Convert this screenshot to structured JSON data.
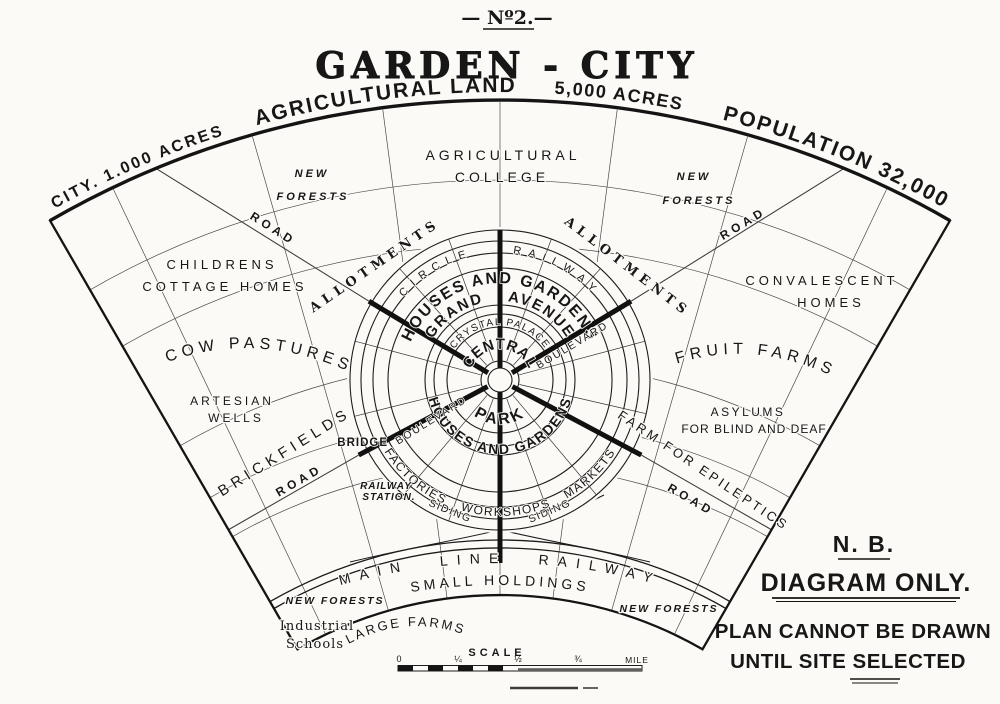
{
  "page": {
    "paper_color": "#fbfaf6",
    "ink_color": "#171717"
  },
  "header": {
    "number_label": "— Nº2.—",
    "title": "GARDEN - CITY"
  },
  "arc_titles": {
    "city_acres": "CITY. 1.000 ACRES",
    "agricultural_land": "AGRICULTURAL LAND",
    "acres_5000": "5,000 ACRES",
    "population": "POPULATION 32,000"
  },
  "city": {
    "circle_railway": "CIRCLE RAILWAY",
    "houses_gardens_top": "HOUSES AND GARDENS",
    "grand_avenue": "GRAND AVENUE",
    "crystal_palace": "CRYSTAL PALACE",
    "central": "CENTRAL",
    "park": "PARK",
    "houses_gardens_bottom": "HOUSES AND GARDENS",
    "factories": "FACTORIES WORKSHOPS MARKETS",
    "boulevard_upper": "BOULEVARD",
    "boulevard_lower": "BOULEVARD",
    "siding_left": "SIDING",
    "siding_right": "SIDING",
    "bridge": "BRIDGE",
    "railway_station_1": "RAILWAY",
    "railway_station_2": "STATION."
  },
  "belt": {
    "agricultural_college_1": "AGRICULTURAL",
    "agricultural_college_2": "COLLEGE",
    "new_forests_top_left_1": "NEW",
    "new_forests_top_left_2": "FORESTS",
    "new_forests_top_right_1": "NEW",
    "new_forests_top_right_2": "FORESTS",
    "childrens_1": "CHILDRENS",
    "childrens_2": "COTTAGE HOMES",
    "convalescent_1": "CONVALESCENT",
    "convalescent_2": "HOMES",
    "cow_pastures": "COW PASTURES",
    "fruit_farms": "FRUIT FARMS",
    "artesian_1": "ARTESIAN",
    "artesian_2": "WELLS",
    "brickfields": "BRICKFIELDS",
    "allotments_left": "ALLOTMENTS",
    "allotments_right": "ALLOTMENTS",
    "asylums_1": "ASYLUMS",
    "asylums_2": "FOR BLIND AND DEAF",
    "farm_epileptics": "FARM FOR EPILEPTICS",
    "road_upper_left": "ROAD",
    "road_upper_right": "ROAD",
    "road_lower_left": "ROAD",
    "road_lower_right": "ROAD",
    "main_line_railway": "MAIN LINE RAILWAY",
    "small_holdings": "SMALL HOLDINGS",
    "new_forests_bottom_left": "NEW FORESTS",
    "new_forests_bottom_right": "NEW FORESTS",
    "industrial_schools_1": "Industrial",
    "industrial_schools_2": "Schools",
    "large_farms": "LARGE FARMS"
  },
  "note": {
    "nb": "N. B.",
    "line1": "DIAGRAM ONLY.",
    "line2": "PLAN CANNOT BE DRAWN",
    "line3": "UNTIL SITE SELECTED"
  },
  "scale_bar": {
    "label": "SCALE",
    "tick0": "0",
    "tick1": "¼",
    "tick2": "½",
    "tick3": "¾",
    "unit": "MILE"
  }
}
